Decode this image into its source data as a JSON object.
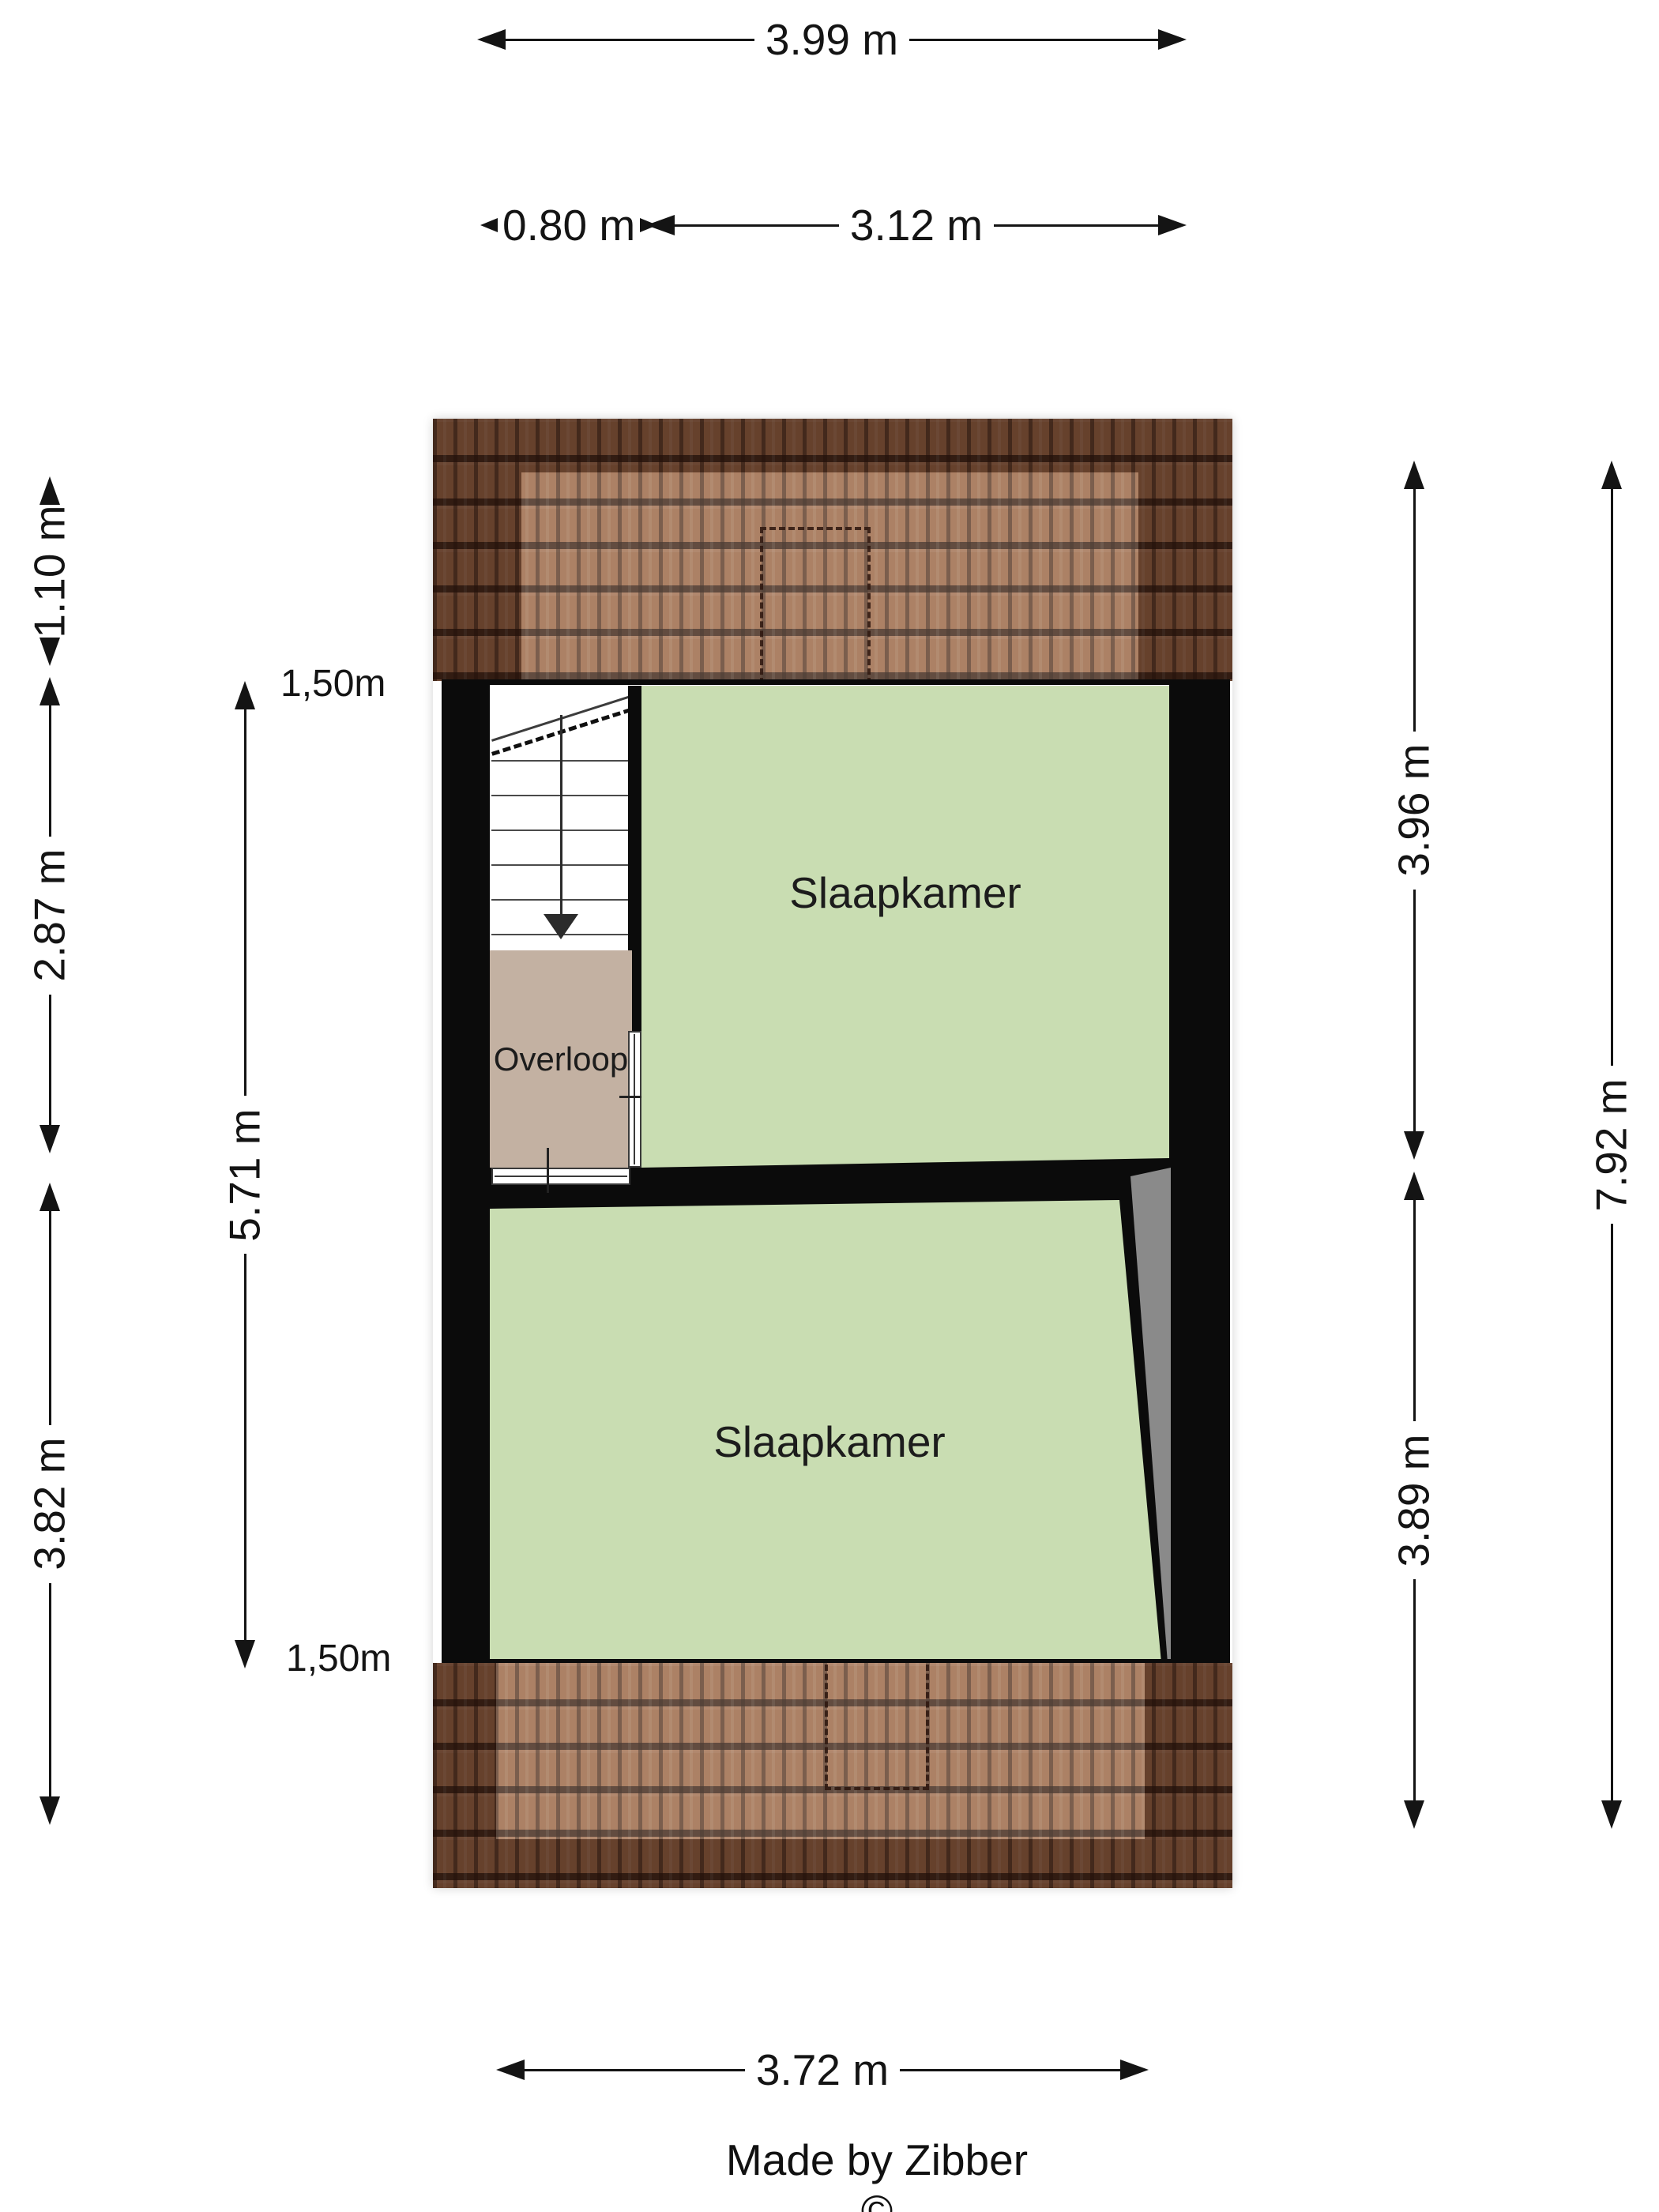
{
  "floorplan": {
    "rooms": {
      "bedroom_top": {
        "label": "Slaapkamer"
      },
      "bedroom_bottom": {
        "label": "Slaapkamer"
      },
      "landing": {
        "label": "Overloop"
      }
    },
    "dimensions": {
      "top_width": "3.99 m",
      "stair_width": "0.80 m",
      "bedroom_top_width": "3.12 m",
      "roof_top_depth": "1.10 m",
      "left_upper_depth": "2.87 m",
      "left_lower_depth": "3.82 m",
      "interior_depth": "5.71 m",
      "headroom_marker_top": "1,50m",
      "headroom_marker_bottom": "1,50m",
      "right_upper_depth": "3.96 m",
      "right_lower_depth": "3.89 m",
      "right_total_depth": "7.92 m",
      "bottom_width": "3.72 m"
    },
    "credit": "Made by Zibber ©",
    "colors": {
      "room_green": "#c9ddb2",
      "landing_tan": "#c3b1a2",
      "wall_black": "#0b0b0b",
      "sloped_area_gray": "#8a8a8a",
      "roof_brown": "#9a6848"
    }
  }
}
